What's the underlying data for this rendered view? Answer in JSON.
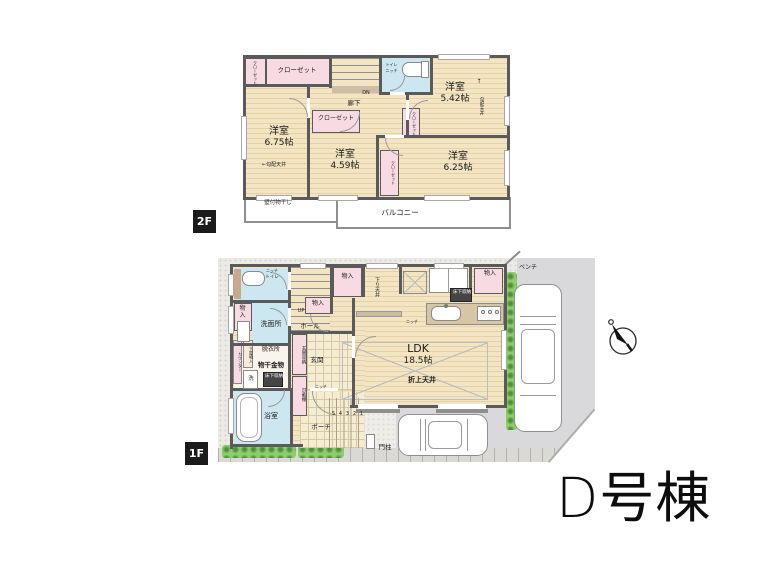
{
  "building": {
    "label": "D号棟"
  },
  "badges": {
    "f2": "2F",
    "f1": "1F"
  },
  "f2": {
    "room_675": {
      "name": "洋室",
      "size": "6.75帖"
    },
    "room_459": {
      "name": "洋室",
      "size": "4.59帖"
    },
    "room_625": {
      "name": "洋室",
      "size": "6.25帖"
    },
    "room_542": {
      "name": "洋室",
      "size": "5.42帖"
    },
    "closet": "クローゼット",
    "hallway": "廊下",
    "dn": "DN",
    "toilet": "トイレ",
    "niche": "ニッチ",
    "sloped_ceiling": "勾配天井",
    "sloped_ceiling_left": "←勾配天井",
    "arrow_up": "↑",
    "wall_laundry": "壁付物干し",
    "balcony": "バルコニー"
  },
  "f1": {
    "ldk": {
      "name": "LDK",
      "size": "18.5帖"
    },
    "hall": "ホール",
    "up": "UP",
    "washroom": "洗面所",
    "dressing": "脱衣所",
    "laundry_hw": "物干金物",
    "underfloor": "床下収納",
    "washer": "洗",
    "counter": "カウンター",
    "geya_storage": "下屋物入",
    "bathroom": "浴室",
    "toilet": "トイレ",
    "niche": "ニッチ",
    "storage": "物入",
    "entrance": "玄関",
    "entrance_storage": "玄関収納",
    "movable_shelf": "可動棚",
    "porch": "ポーチ",
    "steps": [
      "5",
      "4",
      "3",
      "2",
      "1"
    ],
    "gate_post": "門柱",
    "bench": "ベンチ",
    "lowered_ceiling": "下り天井",
    "raised_ceiling": "折上天井"
  }
}
